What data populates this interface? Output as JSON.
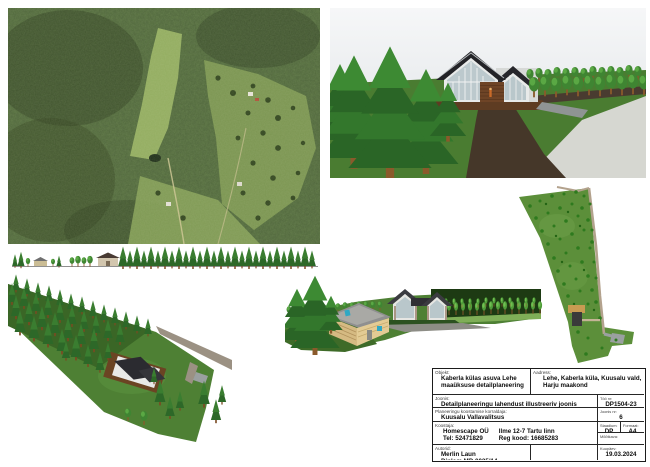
{
  "title_block": {
    "object_label": "Objekt:",
    "object_value": "Kaberla külas asuva Lehe maaüksuse detailplaneering",
    "address_label": "Aadress:",
    "address_value": "Lehe, Kaberla küla, Kuusalu vald, Harju maakond",
    "drawing_label": "Joonis:",
    "drawing_value": "Detailplaneeringu lahendust illustreeriv joonis",
    "work_no_label": "Töö nr:",
    "work_no_value": "DP1504-23",
    "organizer_label": "Planeeringu koostamise korraldaja:",
    "organizer_value": "Kuusalu Vallavalitsus",
    "sheet_no_label": "Joonis nr:",
    "sheet_no_value": "6",
    "compiler_label": "Koostaja:",
    "compiler_company": "Homescape OÜ",
    "compiler_address": "Ilme 12-7  Tartu linn",
    "compiler_phone": "Tel: 52471829",
    "compiler_reg": "Reg kood: 16685283",
    "stage_label": "Staadium:",
    "stage_value": "DP",
    "format_label": "Formaat:",
    "format_value": "A4",
    "scale_label": "Mõõtkava:",
    "authors_label": "Autorid:",
    "author_name": "Merlin Laun",
    "author_cert": "Diplom MD 0025/14",
    "date_label": "Kuupäev:",
    "date_value": "19.03.2024"
  },
  "panels": [
    {
      "name": "aerial-photo",
      "description": "orthophoto of forested plot with clearing"
    },
    {
      "name": "perspective-view-house",
      "description": "3D view of house with glass gables among spruces"
    },
    {
      "name": "elevation-strip",
      "description": "side elevation with tree row and two buildings"
    },
    {
      "name": "birdseye-view",
      "description": "bird's-eye 3D view of elongated plot"
    },
    {
      "name": "perspective-view-sauna-house",
      "description": "3D view of sauna and main house"
    },
    {
      "name": "site-plan",
      "description": "top-down plan of wedge-shaped plot"
    }
  ],
  "colors": {
    "lawn_green": "#4a7c31",
    "forest_dark": "#2a6526",
    "roof_dark": "#26262b",
    "sky": "#eef0f2",
    "road_light": "#d6d7d1",
    "path_dark": "#453729",
    "deck_brown": "#5e3c22",
    "site_green": "#5c8f3a",
    "accent_teal": "#2fa8c4"
  }
}
